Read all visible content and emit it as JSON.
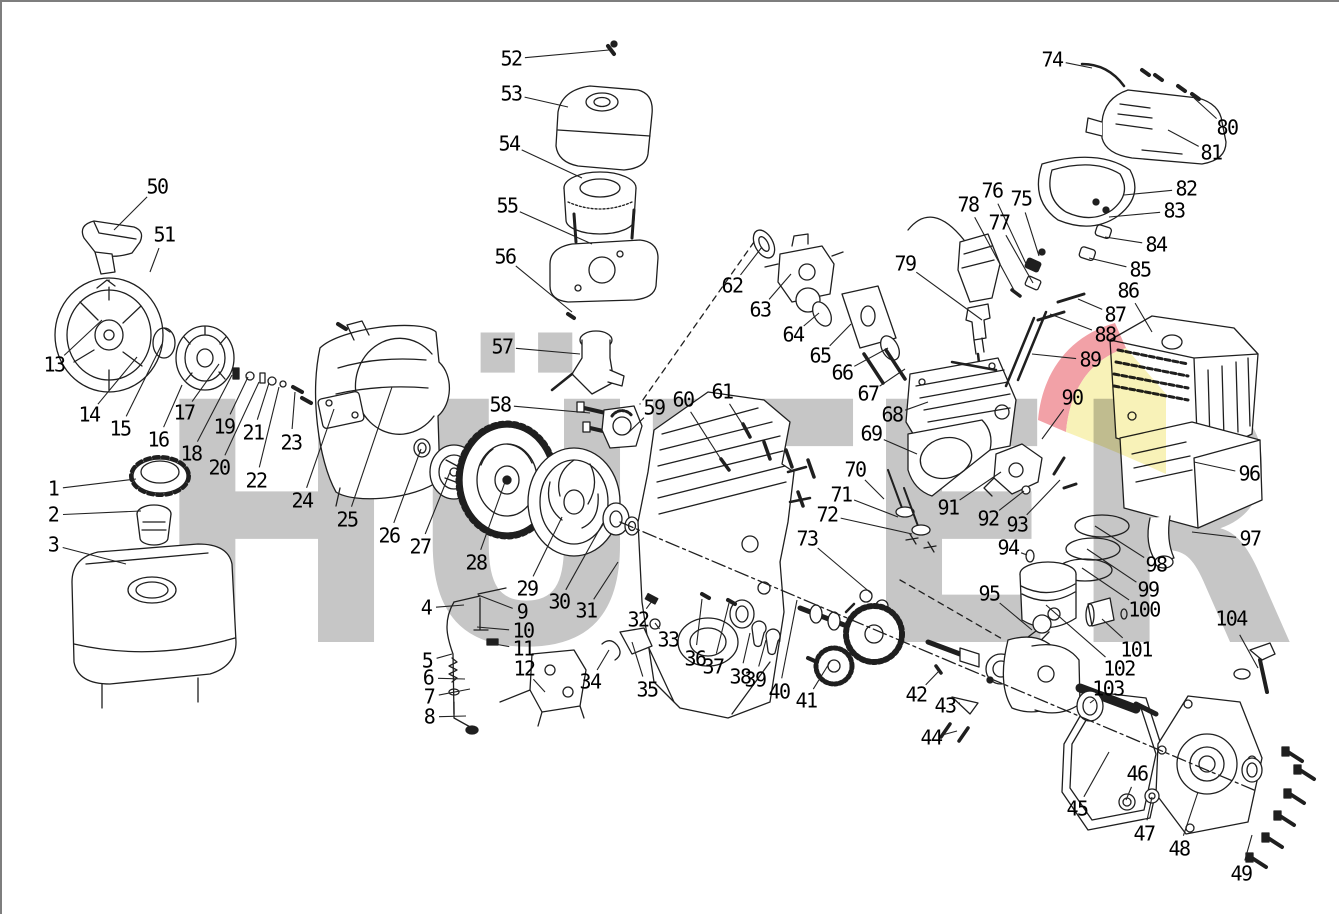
{
  "diagram": {
    "kind": "exploded-parts-diagram",
    "watermark": {
      "text": "HÜTER",
      "letter_color": "#c6c6c6",
      "logo_red": "#f2a1a7",
      "logo_yellow": "#f8f2b8"
    },
    "line_color": "#1f1f1f",
    "leader_color": "#222222",
    "part_count": 104,
    "labels": [
      {
        "n": "1",
        "x": 51,
        "y": 487,
        "tx": 134,
        "ty": 477
      },
      {
        "n": "2",
        "x": 51,
        "y": 513,
        "tx": 139,
        "ty": 509
      },
      {
        "n": "3",
        "x": 51,
        "y": 543,
        "tx": 124,
        "ty": 562
      },
      {
        "n": "4",
        "x": 424,
        "y": 606,
        "tx": 462,
        "ty": 603
      },
      {
        "n": "5",
        "x": 425,
        "y": 659,
        "tx": 450,
        "ty": 652
      },
      {
        "n": "6",
        "x": 426,
        "y": 676,
        "tx": 463,
        "ty": 677
      },
      {
        "n": "7",
        "x": 427,
        "y": 695,
        "tx": 468,
        "ty": 687
      },
      {
        "n": "8",
        "x": 427,
        "y": 715,
        "tx": 464,
        "ty": 714
      },
      {
        "n": "9",
        "x": 520,
        "y": 610,
        "tx": 476,
        "ty": 593
      },
      {
        "n": "10",
        "x": 521,
        "y": 629,
        "tx": 475,
        "ty": 625
      },
      {
        "n": "11",
        "x": 521,
        "y": 647,
        "tx": 487,
        "ty": 641
      },
      {
        "n": "12",
        "x": 522,
        "y": 667,
        "tx": 543,
        "ty": 690
      },
      {
        "n": "13",
        "x": 52,
        "y": 363,
        "tx": 100,
        "ty": 318
      },
      {
        "n": "14",
        "x": 87,
        "y": 413,
        "tx": 135,
        "ty": 355
      },
      {
        "n": "15",
        "x": 118,
        "y": 427,
        "tx": 160,
        "ty": 342
      },
      {
        "n": "16",
        "x": 156,
        "y": 438,
        "tx": 180,
        "ty": 383
      },
      {
        "n": "17",
        "x": 182,
        "y": 411,
        "tx": 217,
        "ty": 362
      },
      {
        "n": "18",
        "x": 189,
        "y": 452,
        "tx": 230,
        "ty": 373
      },
      {
        "n": "19",
        "x": 222,
        "y": 425,
        "tx": 246,
        "ty": 375
      },
      {
        "n": "20",
        "x": 217,
        "y": 466,
        "tx": 257,
        "ty": 380
      },
      {
        "n": "21",
        "x": 251,
        "y": 431,
        "tx": 267,
        "ty": 381
      },
      {
        "n": "22",
        "x": 254,
        "y": 479,
        "tx": 277,
        "ty": 385
      },
      {
        "n": "23",
        "x": 289,
        "y": 441,
        "tx": 293,
        "ty": 390
      },
      {
        "n": "24",
        "x": 300,
        "y": 499,
        "tx": 332,
        "ty": 407
      },
      {
        "n": "25",
        "x": 345,
        "y": 518,
        "tx": 390,
        "ty": 385
      },
      {
        "n": "26",
        "x": 387,
        "y": 534,
        "tx": 419,
        "ty": 447
      },
      {
        "n": "27",
        "x": 418,
        "y": 545,
        "tx": 448,
        "ty": 470
      },
      {
        "n": "28",
        "x": 474,
        "y": 561,
        "tx": 503,
        "ty": 480
      },
      {
        "n": "29",
        "x": 525,
        "y": 587,
        "tx": 560,
        "ty": 515
      },
      {
        "n": "30",
        "x": 557,
        "y": 600,
        "tx": 601,
        "ty": 521
      },
      {
        "n": "31",
        "x": 584,
        "y": 609,
        "tx": 616,
        "ty": 560
      },
      {
        "n": "32",
        "x": 636,
        "y": 618,
        "tx": 650,
        "ty": 599
      },
      {
        "n": "33",
        "x": 666,
        "y": 638,
        "tx": 653,
        "ty": 621
      },
      {
        "n": "34",
        "x": 588,
        "y": 680,
        "tx": 607,
        "ty": 648
      },
      {
        "n": "35",
        "x": 645,
        "y": 688,
        "tx": 630,
        "ty": 640
      },
      {
        "n": "36",
        "x": 693,
        "y": 657,
        "tx": 700,
        "ty": 597
      },
      {
        "n": "37",
        "x": 711,
        "y": 665,
        "tx": 727,
        "ty": 601
      },
      {
        "n": "38",
        "x": 738,
        "y": 675,
        "tx": 748,
        "ty": 631
      },
      {
        "n": "39",
        "x": 753,
        "y": 678,
        "tx": 764,
        "ty": 638
      },
      {
        "n": "40",
        "x": 777,
        "y": 690,
        "tx": 795,
        "ty": 598
      },
      {
        "n": "41",
        "x": 804,
        "y": 699,
        "tx": 828,
        "ty": 660
      },
      {
        "n": "42",
        "x": 914,
        "y": 693,
        "tx": 937,
        "ty": 669
      },
      {
        "n": "43",
        "x": 943,
        "y": 704,
        "tx": 958,
        "ty": 701
      },
      {
        "n": "44",
        "x": 929,
        "y": 736,
        "tx": 955,
        "ty": 729
      },
      {
        "n": "45",
        "x": 1075,
        "y": 807,
        "tx": 1107,
        "ty": 750
      },
      {
        "n": "46",
        "x": 1135,
        "y": 772,
        "tx": 1124,
        "ty": 798
      },
      {
        "n": "47",
        "x": 1142,
        "y": 832,
        "tx": 1150,
        "ty": 795
      },
      {
        "n": "48",
        "x": 1177,
        "y": 847,
        "tx": 1196,
        "ty": 790
      },
      {
        "n": "49",
        "x": 1239,
        "y": 872,
        "tx": 1250,
        "ty": 833
      },
      {
        "n": "50",
        "x": 155,
        "y": 185,
        "tx": 112,
        "ty": 228
      },
      {
        "n": "51",
        "x": 162,
        "y": 233,
        "tx": 148,
        "ty": 270
      },
      {
        "n": "52",
        "x": 509,
        "y": 57,
        "tx": 607,
        "ty": 48
      },
      {
        "n": "53",
        "x": 509,
        "y": 92,
        "tx": 566,
        "ty": 105
      },
      {
        "n": "54",
        "x": 507,
        "y": 142,
        "tx": 580,
        "ty": 176
      },
      {
        "n": "55",
        "x": 505,
        "y": 204,
        "tx": 590,
        "ty": 242
      },
      {
        "n": "56",
        "x": 503,
        "y": 255,
        "tx": 570,
        "ty": 310
      },
      {
        "n": "57",
        "x": 500,
        "y": 345,
        "tx": 578,
        "ty": 352
      },
      {
        "n": "58",
        "x": 498,
        "y": 403,
        "tx": 588,
        "ty": 411
      },
      {
        "n": "59",
        "x": 652,
        "y": 406,
        "tx": 626,
        "ty": 431
      },
      {
        "n": "60",
        "x": 681,
        "y": 398,
        "tx": 722,
        "ty": 462
      },
      {
        "n": "61",
        "x": 720,
        "y": 390,
        "tx": 744,
        "ty": 428
      },
      {
        "n": "62",
        "x": 730,
        "y": 284,
        "tx": 760,
        "ty": 245
      },
      {
        "n": "63",
        "x": 758,
        "y": 308,
        "tx": 789,
        "ty": 272
      },
      {
        "n": "64",
        "x": 791,
        "y": 333,
        "tx": 817,
        "ty": 311
      },
      {
        "n": "65",
        "x": 818,
        "y": 354,
        "tx": 849,
        "ty": 322
      },
      {
        "n": "66",
        "x": 840,
        "y": 371,
        "tx": 886,
        "ty": 346
      },
      {
        "n": "67",
        "x": 866,
        "y": 392,
        "tx": 903,
        "ty": 367
      },
      {
        "n": "68",
        "x": 890,
        "y": 413,
        "tx": 926,
        "ty": 400
      },
      {
        "n": "69",
        "x": 869,
        "y": 432,
        "tx": 915,
        "ty": 452
      },
      {
        "n": "70",
        "x": 853,
        "y": 468,
        "tx": 882,
        "ty": 497
      },
      {
        "n": "71",
        "x": 839,
        "y": 493,
        "tx": 896,
        "ty": 515
      },
      {
        "n": "72",
        "x": 825,
        "y": 513,
        "tx": 910,
        "ty": 532
      },
      {
        "n": "73",
        "x": 805,
        "y": 537,
        "tx": 870,
        "ty": 592
      },
      {
        "n": "74",
        "x": 1050,
        "y": 58,
        "tx": 1090,
        "ty": 66
      },
      {
        "n": "75",
        "x": 1019,
        "y": 197,
        "tx": 1037,
        "ty": 254
      },
      {
        "n": "76",
        "x": 990,
        "y": 189,
        "tx": 1026,
        "ty": 266
      },
      {
        "n": "77",
        "x": 997,
        "y": 221,
        "tx": 1031,
        "ty": 281
      },
      {
        "n": "78",
        "x": 966,
        "y": 203,
        "tx": 1013,
        "ty": 290
      },
      {
        "n": "79",
        "x": 903,
        "y": 262,
        "tx": 980,
        "ty": 318
      },
      {
        "n": "80",
        "x": 1225,
        "y": 126,
        "tx": 1192,
        "ty": 96
      },
      {
        "n": "81",
        "x": 1209,
        "y": 151,
        "tx": 1166,
        "ty": 128
      },
      {
        "n": "82",
        "x": 1184,
        "y": 187,
        "tx": 1122,
        "ty": 193
      },
      {
        "n": "83",
        "x": 1172,
        "y": 209,
        "tx": 1107,
        "ty": 215
      },
      {
        "n": "84",
        "x": 1154,
        "y": 243,
        "tx": 1103,
        "ty": 235
      },
      {
        "n": "85",
        "x": 1138,
        "y": 268,
        "tx": 1087,
        "ty": 256
      },
      {
        "n": "86",
        "x": 1126,
        "y": 289,
        "tx": 1150,
        "ty": 330
      },
      {
        "n": "87",
        "x": 1113,
        "y": 313,
        "tx": 1076,
        "ty": 297
      },
      {
        "n": "88",
        "x": 1103,
        "y": 333,
        "tx": 1048,
        "ty": 312
      },
      {
        "n": "89",
        "x": 1088,
        "y": 358,
        "tx": 1030,
        "ty": 352
      },
      {
        "n": "90",
        "x": 1070,
        "y": 396,
        "tx": 1040,
        "ty": 437
      },
      {
        "n": "91",
        "x": 946,
        "y": 506,
        "tx": 999,
        "ty": 470
      },
      {
        "n": "92",
        "x": 986,
        "y": 517,
        "tx": 1022,
        "ty": 489
      },
      {
        "n": "93",
        "x": 1015,
        "y": 523,
        "tx": 1058,
        "ty": 478
      },
      {
        "n": "94",
        "x": 1006,
        "y": 546,
        "tx": 1025,
        "ty": 553
      },
      {
        "n": "95",
        "x": 987,
        "y": 592,
        "tx": 1030,
        "ty": 628
      },
      {
        "n": "96",
        "x": 1247,
        "y": 472,
        "tx": 1192,
        "ty": 460
      },
      {
        "n": "97",
        "x": 1248,
        "y": 537,
        "tx": 1190,
        "ty": 530
      },
      {
        "n": "98",
        "x": 1154,
        "y": 563,
        "tx": 1093,
        "ty": 524
      },
      {
        "n": "99",
        "x": 1146,
        "y": 588,
        "tx": 1085,
        "ty": 547
      },
      {
        "n": "100",
        "x": 1142,
        "y": 608,
        "tx": 1080,
        "ty": 566
      },
      {
        "n": "101",
        "x": 1134,
        "y": 648,
        "tx": 1100,
        "ty": 617
      },
      {
        "n": "102",
        "x": 1117,
        "y": 667,
        "tx": 1044,
        "ty": 603
      },
      {
        "n": "103",
        "x": 1106,
        "y": 687,
        "tx": 1088,
        "ty": 701
      },
      {
        "n": "104",
        "x": 1229,
        "y": 617,
        "tx": 1256,
        "ty": 666
      }
    ]
  }
}
